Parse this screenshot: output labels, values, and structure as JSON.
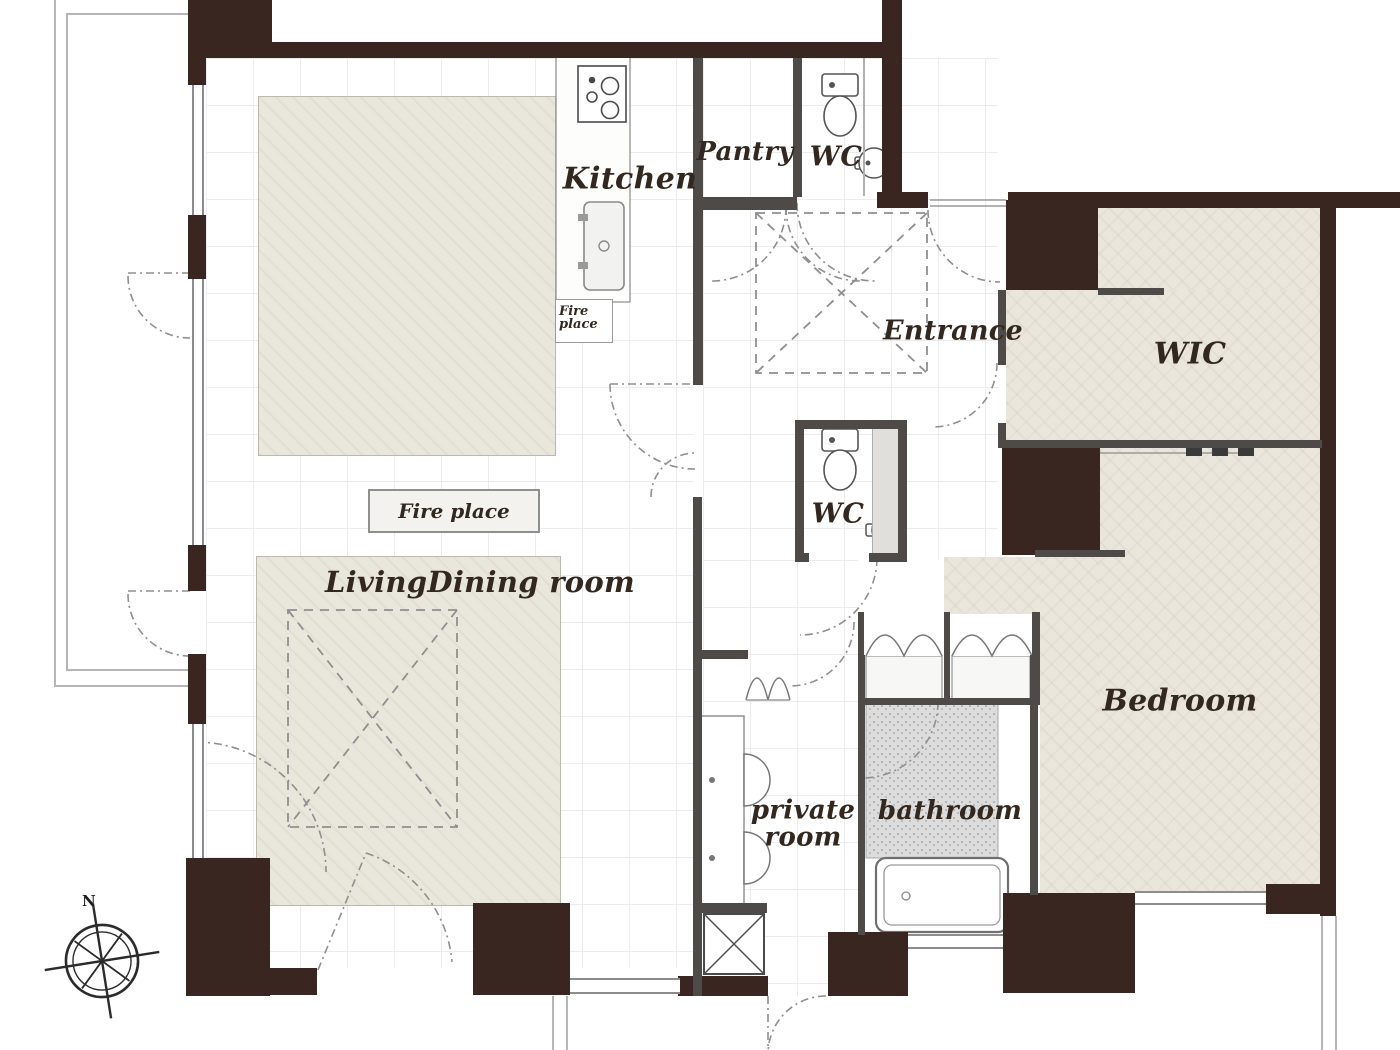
{
  "plan": {
    "rooms": {
      "kitchen": {
        "label": "Kitchen"
      },
      "pantry": {
        "label": "Pantry"
      },
      "wc_upper": {
        "label": "WC"
      },
      "entrance": {
        "label": "Entrance"
      },
      "wic": {
        "label": "WIC"
      },
      "living_dining": {
        "label": "LivingDining room"
      },
      "wc_lower": {
        "label": "WC"
      },
      "bedroom": {
        "label": "Bedroom"
      },
      "private_room": {
        "line1": "private",
        "line2": "room"
      },
      "bathroom": {
        "label": "bathroom"
      }
    },
    "features": {
      "fireplace_box_label": "Fire place",
      "fireplace_small_line1": "Fire",
      "fireplace_small_line2": "place"
    },
    "compass": {
      "north": "N"
    },
    "colors": {
      "wall": "#3a2620",
      "partition": "#4e4a47",
      "room_fill": "#eae6dc",
      "bath_floor": "#dcdcdc",
      "plan_line": "#8f8f8f"
    }
  }
}
